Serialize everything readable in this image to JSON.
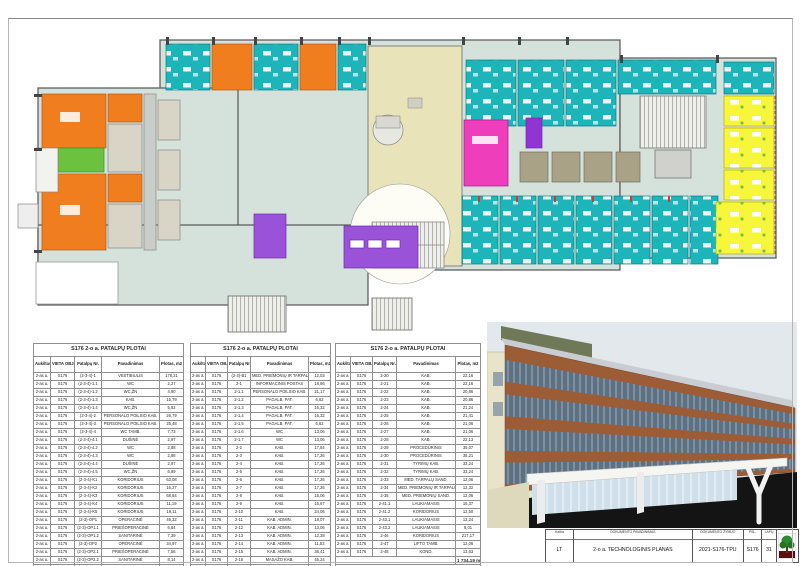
{
  "tables": [
    {
      "title": "S176 2-o a. PATALPŲ PLOTAI",
      "columns": [
        "Aukštas",
        "VIETA OBJEKTE",
        "Patalpų Nr.",
        "Pavadinimas",
        "Plotas, m2"
      ],
      "floor": "2-as a.",
      "site": "S176",
      "rows": [
        [
          "(2-3-4)-1",
          "VESTIBIULIS",
          "178,21"
        ],
        [
          "(2-3-4)-1.1",
          "WC",
          "2,27"
        ],
        [
          "(2-3-4)-1.2",
          "WC,ŽN",
          "4,90"
        ],
        [
          "(2-3-4)-1.3",
          "KAB.",
          "15,79"
        ],
        [
          "(2-3-4)-1.4",
          "WC,ŽN",
          "5,82"
        ],
        [
          "(2-3-4)-2",
          "PERSONALO POILSIO KAB.",
          "26,79"
        ],
        [
          "(2-3-4)-3",
          "PERSONALO POILSIO KAB.",
          "25,48"
        ],
        [
          "(2-3-4)-4",
          "WC TAMB.",
          "7,73"
        ],
        [
          "(2-3-4)-4.1",
          "DUŠINĖ",
          "2,97"
        ],
        [
          "(2-3-4)-4.2",
          "WC",
          "2,88"
        ],
        [
          "(2-3-4)-4.3",
          "WC",
          "2,88"
        ],
        [
          "(2-3-4)-4.4",
          "DUŠINĖ",
          "2,97"
        ],
        [
          "(2-3-4)-4.5",
          "WC,ŽN",
          "6,89"
        ],
        [
          "(2-3-4)-K1",
          "KORIDORIUS",
          "63,08"
        ],
        [
          "(2-3-4)-K2",
          "KORIDORIUS",
          "16,27"
        ],
        [
          "(2-3-4)-K3",
          "KORIDORIUS",
          "68,84"
        ],
        [
          "(2-3-4)-K4",
          "KORIDORIUS",
          "11,19"
        ],
        [
          "(2-3-4)-K5",
          "KORIDORIUS",
          "19,11"
        ],
        [
          "(2-3)-OP1",
          "OPERACINĖ",
          "46,32"
        ],
        [
          "(2-3)-OP1.1",
          "PRIEŠOPERACINĖ",
          "6,84"
        ],
        [
          "(2-3)-OP1.2",
          "SANITARINĖ",
          "7,39"
        ],
        [
          "(2-3)-OP2",
          "OPERACINĖ",
          "34,97"
        ],
        [
          "(2-3)-OP2.1",
          "PRIEŠOPERACINĖ",
          "7,56"
        ],
        [
          "(2-3)-OP2.2",
          "SANITARINĖ",
          "8,14"
        ],
        [
          "(2-3)-OP3",
          "MED. STERILI ZONA",
          "13,76"
        ],
        [
          "(2-3)-OP3.1",
          "WC",
          "2,83"
        ],
        [
          "(2-3)-OP3.2",
          "PERSONALO TAMB.",
          "11,08"
        ]
      ],
      "total": null
    },
    {
      "title": "S176 2-o a. PATALPŲ PLOTAI",
      "columns": [
        "Aukštas",
        "VIETA OBJEKTE",
        "Patalpų Nr.",
        "Pavadinimas",
        "Plotas, m2"
      ],
      "floor": "2-as a.",
      "site": "S176",
      "rows": [
        [
          "(2-3)-B1",
          "MED. PRIEMONIŲ IR TARPALŲ PAT.",
          "12,03"
        ],
        [
          "2-1",
          "INFORMACINIS POSTAS",
          "18,86"
        ],
        [
          "2-1.1",
          "PERSONALO POILSIO KAB.",
          "21,17"
        ],
        [
          "2-1.2",
          "PAGALB. PAT.",
          "6,62"
        ],
        [
          "2-1.3",
          "PAGALB. PAT.",
          "16,32"
        ],
        [
          "2-1.4",
          "PAGALB. PAT.",
          "16,32"
        ],
        [
          "2-1.5",
          "PAGALB. PAT.",
          "6,62"
        ],
        [
          "2-1.6",
          "WC",
          "13,06"
        ],
        [
          "2-1.7",
          "WC",
          "13,06"
        ],
        [
          "2-2",
          "KAB.",
          "17,84"
        ],
        [
          "2-3",
          "KAB.",
          "17,26"
        ],
        [
          "2-4",
          "KAB.",
          "17,26"
        ],
        [
          "2-5",
          "KAB.",
          "17,26"
        ],
        [
          "2-6",
          "KAB.",
          "17,26"
        ],
        [
          "2-7",
          "KAB.",
          "17,26"
        ],
        [
          "2-8",
          "KAB.",
          "15,06"
        ],
        [
          "2-9",
          "KAB.",
          "15,67"
        ],
        [
          "2-10",
          "KAB.",
          "24,06"
        ],
        [
          "2-11",
          "KAB. ADMIN.",
          "18,07"
        ],
        [
          "2-12",
          "KAB. ADMIN.",
          "13,06"
        ],
        [
          "2-13",
          "KAB. ADMIN.",
          "12,28"
        ],
        [
          "2-14",
          "KAB. ADMIN.",
          "11,53"
        ],
        [
          "2-15",
          "KAB. ADMIN.",
          "36,41"
        ],
        [
          "2-16",
          "MASAŽO KAB.",
          "45,24"
        ],
        [
          "2-17",
          "KAB.",
          "22,06"
        ],
        [
          "2-18",
          "KAB.",
          "27,06"
        ],
        [
          "2-19",
          "KAB.",
          "27,02"
        ]
      ],
      "total": null
    },
    {
      "title": "S176 2-o a. PATALPŲ PLOTAI",
      "columns": [
        "Aukštas",
        "VIETA OBJEKTE",
        "Patalpų Nr.",
        "Pavadinimas",
        "Plotas, m2"
      ],
      "floor": "2-as a.",
      "site": "S176",
      "rows": [
        [
          "2-20",
          "KAB.",
          "22,16"
        ],
        [
          "2-21",
          "KAB.",
          "22,16"
        ],
        [
          "2-22",
          "KAB.",
          "20,86"
        ],
        [
          "2-23",
          "KAB.",
          "20,86"
        ],
        [
          "2-24",
          "KAB.",
          "21,24"
        ],
        [
          "2-25",
          "KAB.",
          "21,41"
        ],
        [
          "2-26",
          "KAB.",
          "21,06"
        ],
        [
          "2-27",
          "KAB.",
          "21,06"
        ],
        [
          "2-28",
          "KAB.",
          "22,13"
        ],
        [
          "2-29",
          "PROCEDŪRINIS",
          "35,07"
        ],
        [
          "2-30",
          "PROCEDŪRINIS",
          "35,21"
        ],
        [
          "2-31",
          "TYRIMŲ KAB.",
          "33,24"
        ],
        [
          "2-32",
          "TYRIMŲ KAB.",
          "33,24"
        ],
        [
          "2-33",
          "MED. TARPALŲ SAND.",
          "12,06"
        ],
        [
          "2-34",
          "MED. PRIEMONIŲ IR TARPALŲ PAT.",
          "12,32"
        ],
        [
          "2-35",
          "MED. PRIEMONIŲ SAND.",
          "12,06"
        ],
        [
          "2-41.1",
          "LAUKIAMASIS",
          "15,37"
        ],
        [
          "2-41.2",
          "KORIDORIUS",
          "12,50"
        ],
        [
          "2-43.1",
          "LAUKIAMASIS",
          "13,24"
        ],
        [
          "2-43.2",
          "LAUKIAMASIS",
          "8,01"
        ],
        [
          "2-46",
          "KORIDORIUS",
          "217,17"
        ],
        [
          "2-47",
          "LIFTO TAMB.",
          "12,06"
        ],
        [
          "2-48",
          "KOND.",
          "13,63"
        ]
      ],
      "total": "1 734,19 m²"
    }
  ],
  "title_block": {
    "kalba_label": "Kalba",
    "kalba": "LT",
    "doc_name_label": "DOKUMENTO PAVADINIMAS",
    "doc_name": "2-o a. TECHNOLOGINIS PLANAS",
    "doc_code_label": "DOKUMENTO ŽYMUO",
    "doc_code": "2021-S176-TPU",
    "psl_label": "PSL.",
    "psl": "S176",
    "lapu_label": "LAPŲ",
    "lapu": "31",
    "logo_icon": "tree-logo"
  },
  "plan_colors": {
    "ward_teal": "#1db4ba",
    "operating_orange": "#f07d1e",
    "office_yellow": "#f8f63a",
    "staff_purple": "#9a52d8",
    "reception_magenta": "#ee3ebc",
    "or_green": "#6cc13e",
    "vestibule_beige": "#e9e3b9",
    "base_grey_green": "#d5e2dc"
  }
}
